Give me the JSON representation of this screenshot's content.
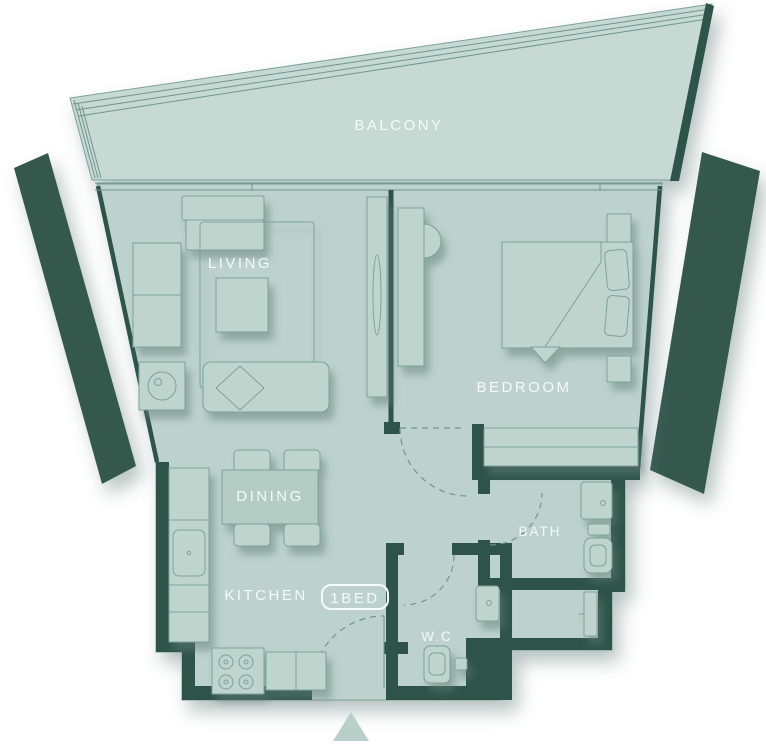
{
  "plan": {
    "type": "floor-plan",
    "unit_badge": {
      "label": "1BED"
    },
    "rooms": {
      "balcony": {
        "label": "BALCONY"
      },
      "living": {
        "label": "LIVING"
      },
      "bedroom": {
        "label": "BEDROOM"
      },
      "dining": {
        "label": "DINING"
      },
      "kitchen": {
        "label": "KITCHEN"
      },
      "bath": {
        "label": "BATH"
      },
      "wc": {
        "label": "W.C"
      }
    },
    "icons": {
      "entry_arrow": "triangle-up-entry-marker"
    }
  },
  "colors": {
    "background": "#ffffff",
    "floor": "#bdd2cc",
    "balcony": "#c7d9d3",
    "wall": "#2f5348",
    "fin": "#36594e",
    "furniture": "#c0d4ce",
    "furniture_dark": "#b5ccc5",
    "outline": "#7ca299",
    "thin": "#6f968c",
    "label": "#f4faf8",
    "arrow": "#b9cfc9"
  }
}
